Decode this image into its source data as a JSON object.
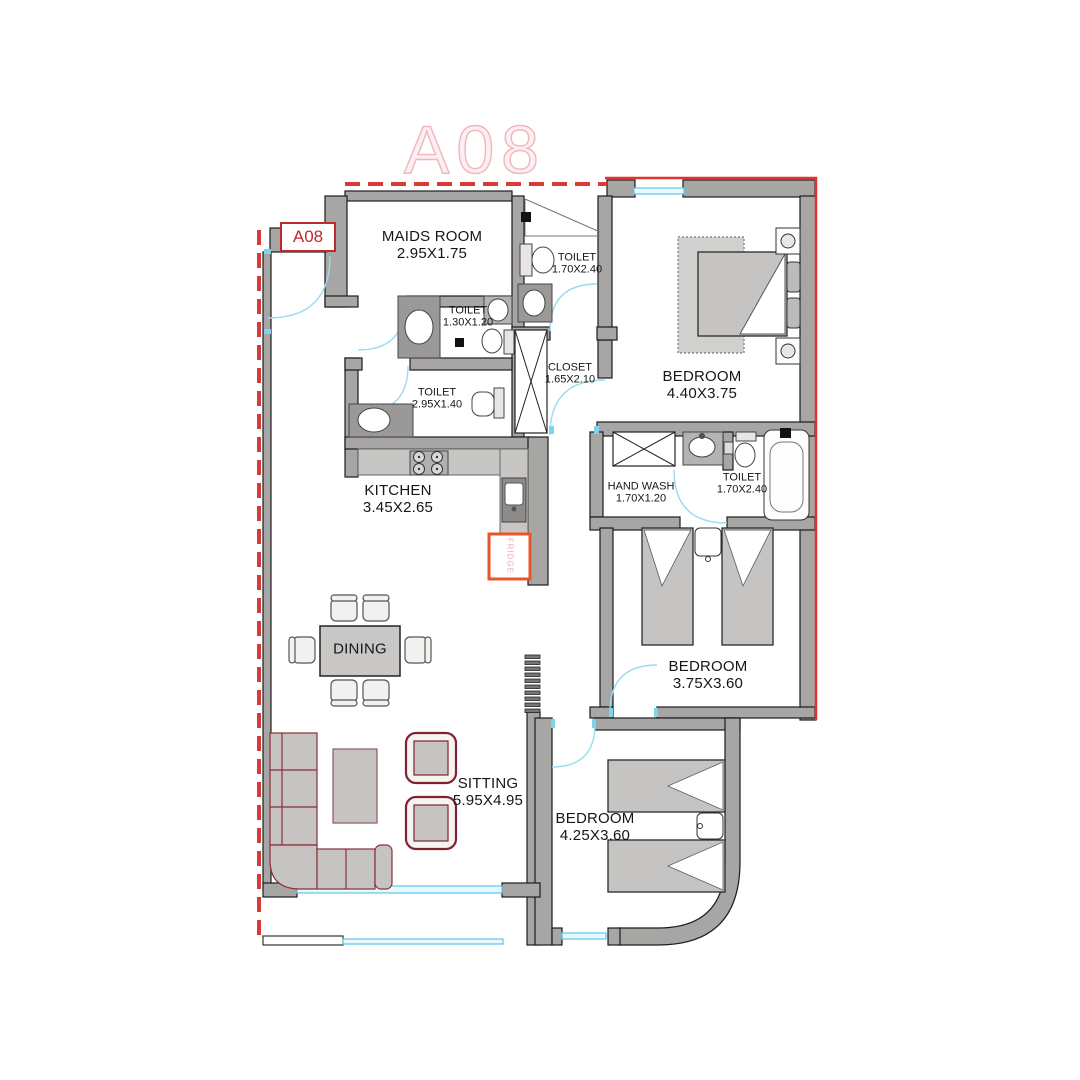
{
  "unit": {
    "watermark": "A08",
    "tag": "A08"
  },
  "rooms": [
    {
      "id": "maids-room",
      "name": "MAIDS ROOM",
      "dims": "2.95X1.75"
    },
    {
      "id": "toilet-top",
      "name": "TOILET",
      "dims": "1.70X2.40"
    },
    {
      "id": "toilet-small",
      "name": "TOILET",
      "dims": "1.30X1.20"
    },
    {
      "id": "toilet-mid",
      "name": "TOILET",
      "dims": "2.95X1.40"
    },
    {
      "id": "closet",
      "name": "CLOSET",
      "dims": "1.65X2.10"
    },
    {
      "id": "bedroom-master",
      "name": "BEDROOM",
      "dims": "4.40X3.75"
    },
    {
      "id": "kitchen",
      "name": "KITCHEN",
      "dims": "3.45X2.65"
    },
    {
      "id": "hand-wash",
      "name": "HAND WASH",
      "dims": "1.70X1.20"
    },
    {
      "id": "toilet-bedroom",
      "name": "TOILET",
      "dims": "1.70X2.40"
    },
    {
      "id": "bedroom-middle",
      "name": "BEDROOM",
      "dims": "3.75X3.60"
    },
    {
      "id": "dining",
      "name": "DINING",
      "dims": ""
    },
    {
      "id": "sitting",
      "name": "SITTING",
      "dims": "5.95X4.95"
    },
    {
      "id": "bedroom-bottom",
      "name": "BEDROOM",
      "dims": "4.25X3.60"
    }
  ],
  "appliances": {
    "fridge": "FRIDGE"
  },
  "colors": {
    "boundary_dash_red": "#d83a3a",
    "boundary_solid_red": "#e23232",
    "wall_gray": "#a8a6a4",
    "window_cyan": "#5bc8e8",
    "door_arc_cyan": "#9adcf0",
    "tag_red": "#c0282d",
    "sofa_outline_red": "#7e232b",
    "fridge_orange": "#e8552a",
    "watermark_pink": "#efb6bd"
  }
}
